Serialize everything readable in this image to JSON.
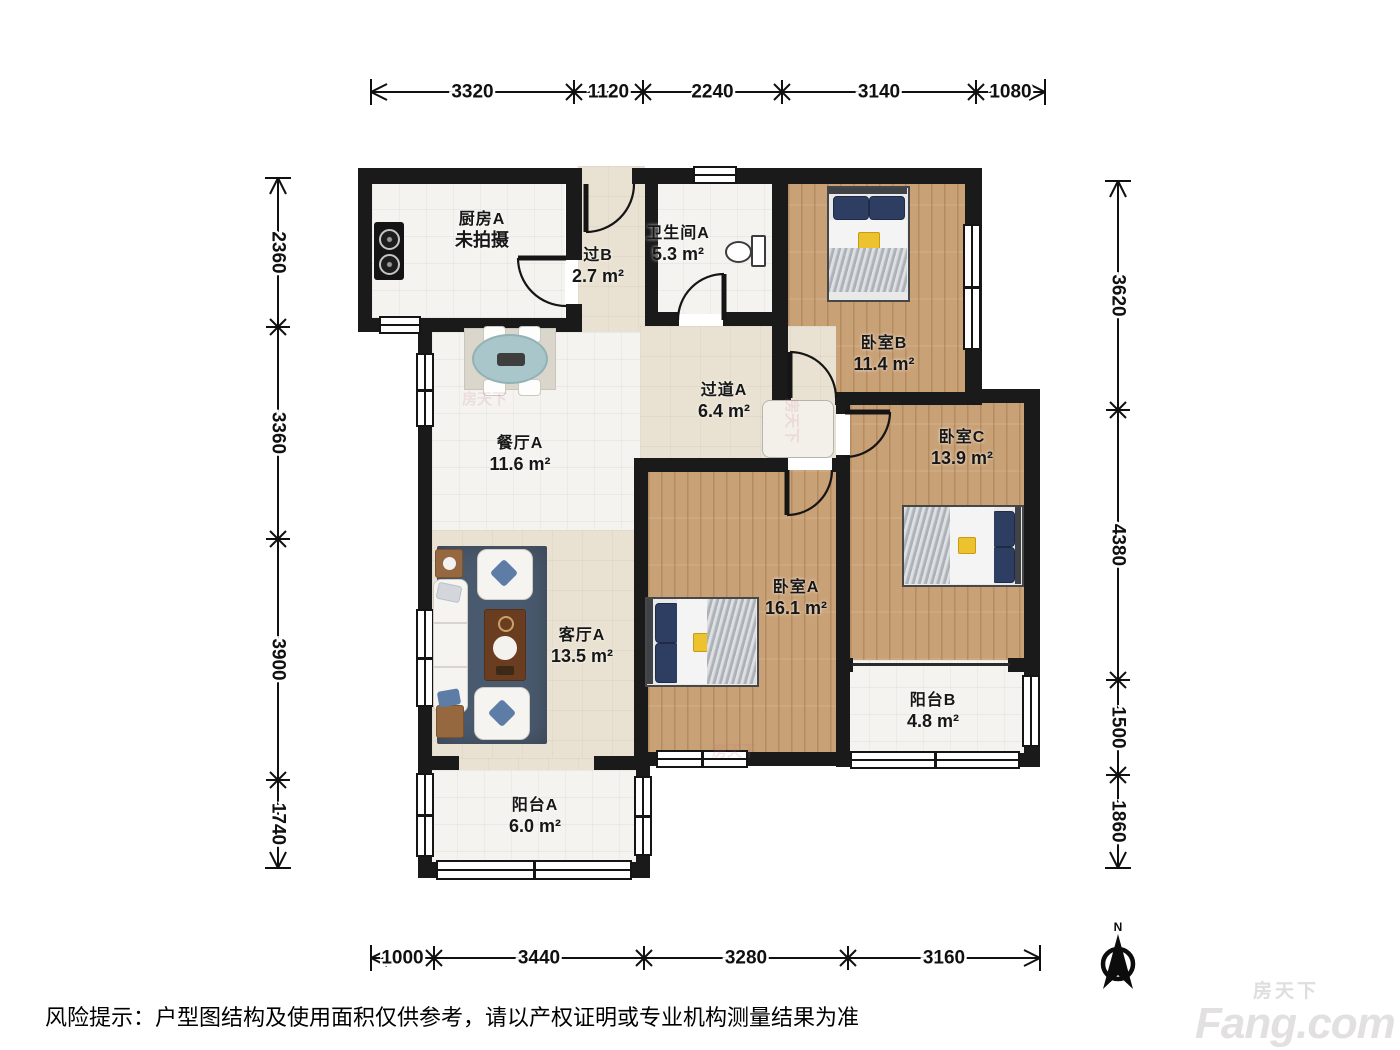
{
  "meta": {
    "disclaimer": "风险提示：户型图结构及使用面积仅供参考，请以产权证明或专业机构测量结果为准",
    "compass_label": "N"
  },
  "brand": {
    "cn": "房天下",
    "en": "Fang.com"
  },
  "watermark": {
    "text": "房天下"
  },
  "rooms": [
    {
      "id": "kitchen",
      "name": "厨房A",
      "area": "未拍摄"
    },
    {
      "id": "passage-b",
      "name": "过B",
      "area": "2.7 m²"
    },
    {
      "id": "bathroom",
      "name": "卫生间A",
      "area": "5.3 m²"
    },
    {
      "id": "bedroom-b",
      "name": "卧室B",
      "area": "11.4 m²"
    },
    {
      "id": "hallway-a",
      "name": "过道A",
      "area": "6.4 m²"
    },
    {
      "id": "bedroom-c",
      "name": "卧室C",
      "area": "13.9 m²"
    },
    {
      "id": "dining-a",
      "name": "餐厅A",
      "area": "11.6 m²"
    },
    {
      "id": "bedroom-a",
      "name": "卧室A",
      "area": "16.1 m²"
    },
    {
      "id": "living-a",
      "name": "客厅A",
      "area": "13.5 m²"
    },
    {
      "id": "balcony-b",
      "name": "阳台B",
      "area": "4.8 m²"
    },
    {
      "id": "balcony-a",
      "name": "阳台A",
      "area": "6.0 m²"
    }
  ],
  "dims": {
    "top": [
      "3320",
      "1120",
      "2240",
      "3140",
      "1080"
    ],
    "bottom": [
      "1000",
      "3440",
      "3280",
      "3160"
    ],
    "left": [
      "2360",
      "3360",
      "3900",
      "1740"
    ],
    "right": [
      "3620",
      "4380",
      "1500",
      "1860"
    ]
  }
}
